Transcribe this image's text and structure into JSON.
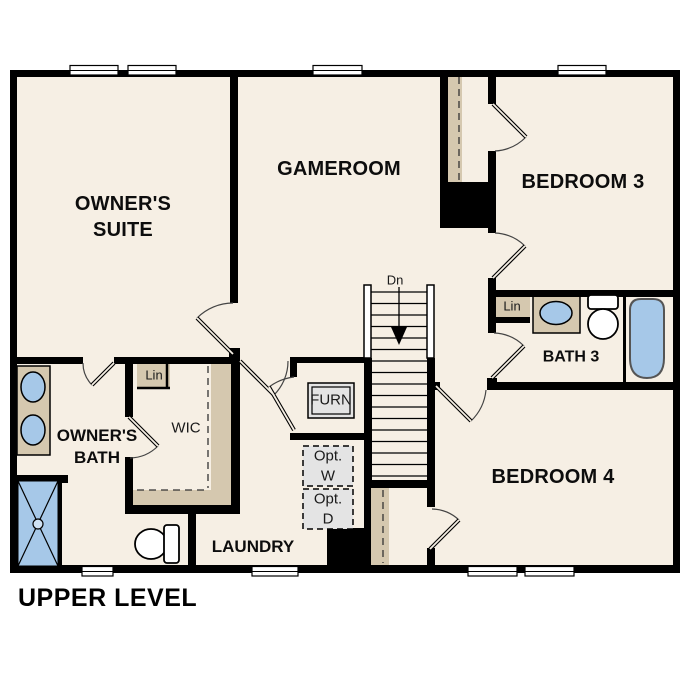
{
  "title": "UPPER LEVEL",
  "rooms": {
    "owners_suite": "OWNER'S SUITE",
    "gameroom": "GAMEROOM",
    "bedroom3": "BEDROOM 3",
    "bath3": "BATH 3",
    "bedroom4": "BEDROOM 4",
    "owners_bath": "OWNER'S BATH",
    "wic": "WIC",
    "laundry": "LAUNDRY"
  },
  "annotations": {
    "furnace": "FURN",
    "linen_wic": "Lin",
    "linen_bath3": "Lin",
    "optional_washer": "Opt. W",
    "optional_dryer": "Opt. D",
    "stairs_down": "Dn"
  },
  "colors": {
    "wall": "#000000",
    "floor": "#f6efe4",
    "casework_tan": "#d5c8af",
    "fixture_blue": "#a6c8e8",
    "appliance_gray": "#e4e4e4",
    "background": "#ffffff"
  }
}
